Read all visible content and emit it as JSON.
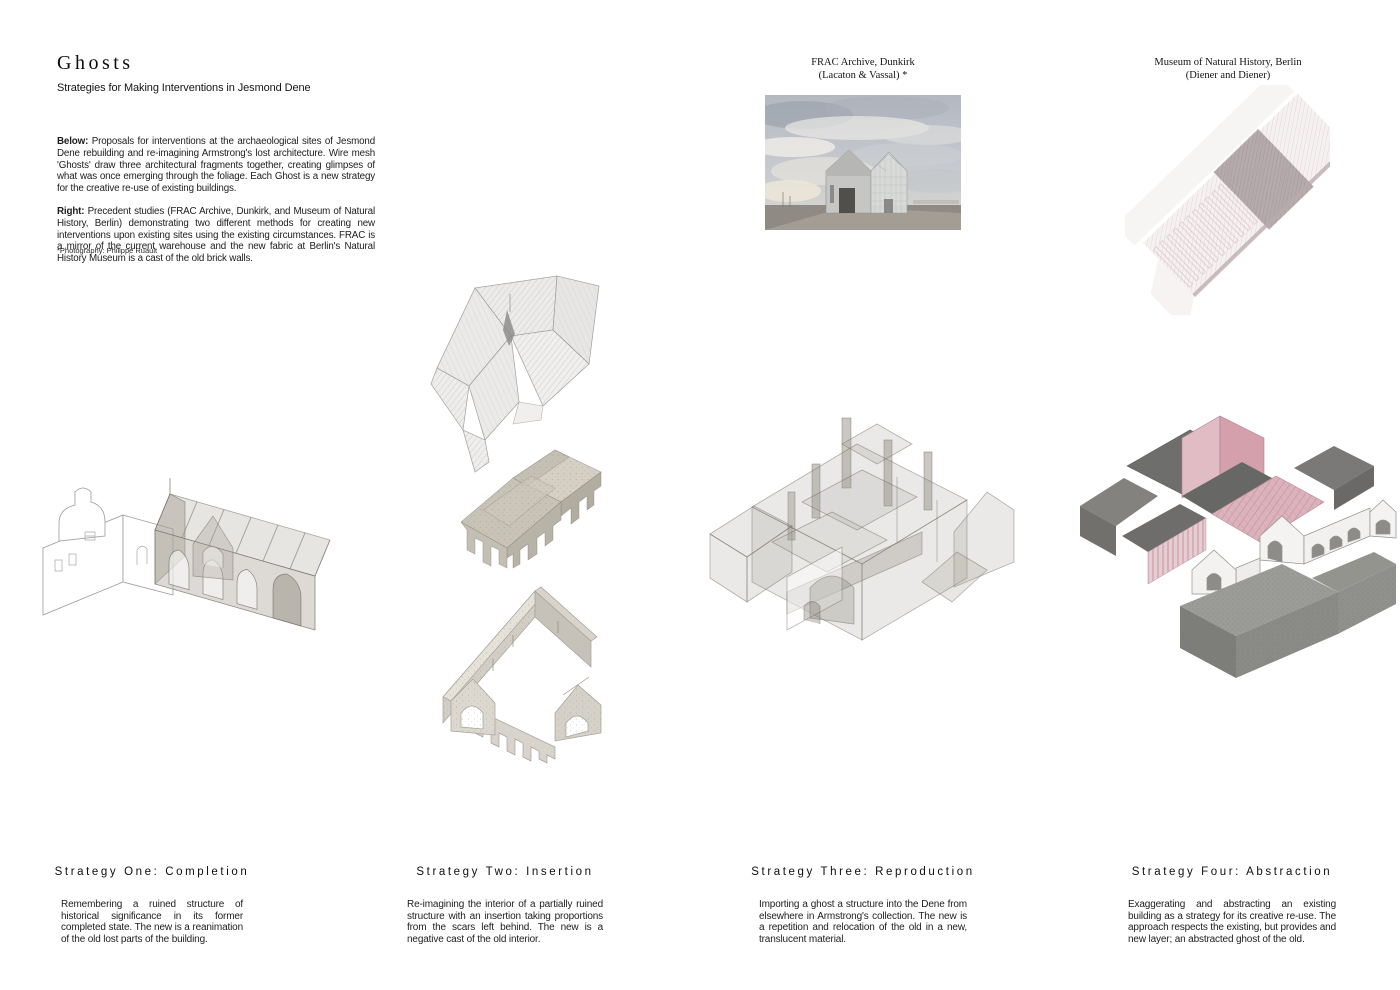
{
  "header": {
    "title": "Ghosts",
    "subtitle": "Strategies for Making Interventions in Jesmond Dene"
  },
  "intro": {
    "below_label": "Below:",
    "below_text": " Proposals for interventions at the archaeological sites of Jesmond Dene rebuilding and re-imagining Armstrong's lost architecture. Wire mesh 'Ghosts' draw three architectural fragments together, creating glimpses of what was once emerging through the foliage. Each Ghost is a new strategy for the creative re-use of existing buildings.",
    "right_label": "Right:",
    "right_text": " Precedent studies (FRAC Archive, Dunkirk, and Museum of Natural History, Berlin) demonstrating two different methods for creating new interventions upon existing sites using the existing circumstances. FRAC is a mirror of the current warehouse and the new fabric at Berlin's Natural History Museum is a cast of the old brick walls.",
    "footnote": "*Photography: Philippe Ruault"
  },
  "precedents": {
    "frac": {
      "caption_line1": "FRAC Archive, Dunkirk",
      "caption_line2": "(Lacaton & Vassal) *"
    },
    "museum": {
      "caption_line1": "Museum of Natural History, Berlin",
      "caption_line2": "(Diener and Diener)"
    }
  },
  "strategies": [
    {
      "heading": "Strategy One: Completion",
      "description": "Remembering a ruined structure of historical significance in its former completed state. The new is a reanimation of the old lost parts of the building."
    },
    {
      "heading": "Strategy Two: Insertion",
      "description": "Re-imagining the interior of a partially ruined structure with an insertion taking proportions from the scars left behind. The new is a negative cast of the old interior."
    },
    {
      "heading": "Strategy Three: Reproduction",
      "description": "Importing a ghost a structure into the Dene from elsewhere in Armstrong's collection. The new is a repetition and relocation of the old in a new, translucent material."
    },
    {
      "heading": "Strategy Four: Abstraction",
      "description": "Exaggerating and abstracting an existing building as a strategy for its creative re-use. The approach respects the existing, but provides and new layer; an abstracted ghost of the old."
    }
  ],
  "colors": {
    "ink": "#1c1c1c",
    "ghost_grey": "#b3ada2",
    "abstraction_pink": "#d4a7b2"
  }
}
